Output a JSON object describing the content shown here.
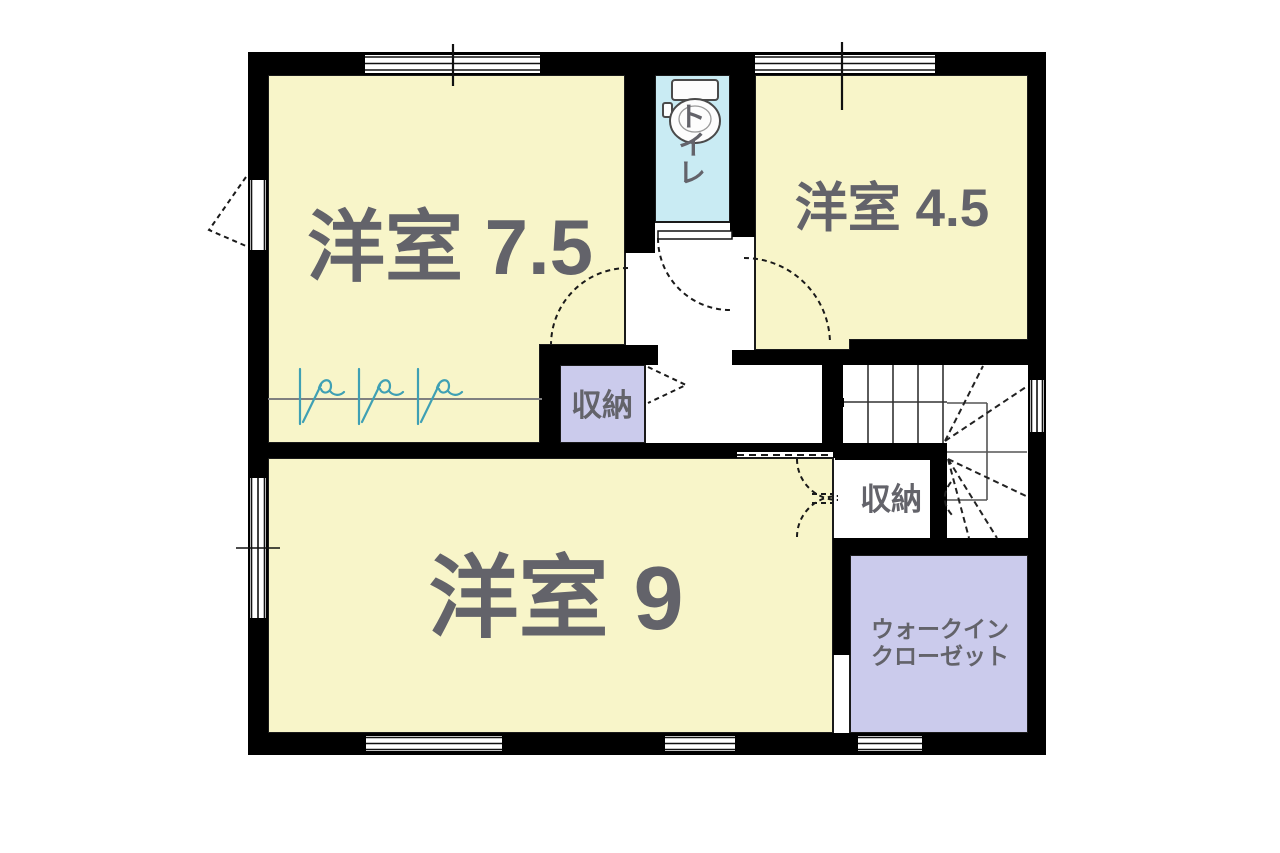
{
  "floorplan": {
    "labels": {
      "room_7_5": "洋室 7.5",
      "room_4_5": "洋室 4.5",
      "room_9": "洋室 9",
      "toilet": "トイレ",
      "storage_1": "収納",
      "storage_2": "収納",
      "wic_line1": "ウォークイン",
      "wic_line2": "クローゼット"
    },
    "colors": {
      "room_fill": "#F8F5C9",
      "toilet_fill": "#C9EBF3",
      "storage_fill": "#CBCBEC",
      "wall": "#000000",
      "label_text": "#63636A",
      "squiggle": "#3FA0B4",
      "outline": "#1A1A1A"
    },
    "icons": {
      "toilet": "toilet-icon"
    }
  }
}
